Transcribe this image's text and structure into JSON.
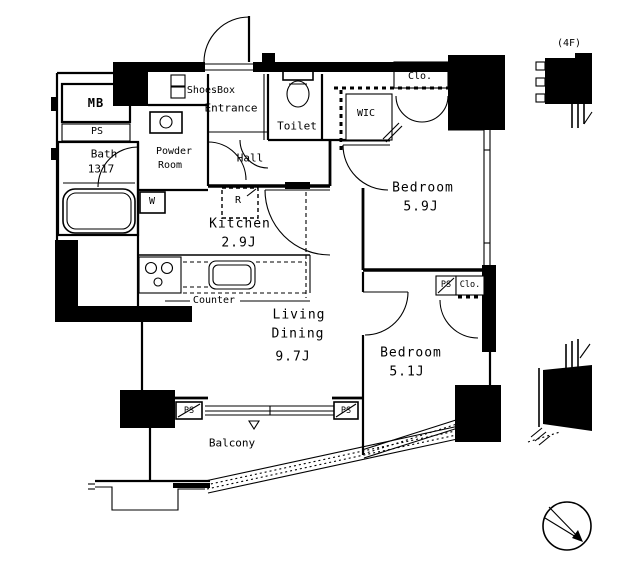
{
  "meta": {
    "floor_tag": "(4F)"
  },
  "rooms": {
    "entrance": {
      "label": "Entrance"
    },
    "shoes_box": {
      "label": "ShoesBox"
    },
    "hall": {
      "label": "Hall"
    },
    "toilet": {
      "label": "Toilet"
    },
    "wic": {
      "label": "WIC"
    },
    "powder_room": {
      "line1": "Powder",
      "line2": "Room"
    },
    "bath": {
      "label": "Bath",
      "size": "1317"
    },
    "kitchen": {
      "label": "Kitchen",
      "size": "2.9J"
    },
    "living_dining": {
      "line1": "Living",
      "line2": "Dining",
      "size": "9.7J"
    },
    "bedroom_1": {
      "label": "Bedroom",
      "size": "5.9J"
    },
    "bedroom_2": {
      "label": "Bedroom",
      "size": "5.1J"
    },
    "balcony": {
      "label": "Balcony"
    }
  },
  "fixtures": {
    "meter_box": "MB",
    "pipe_space": "PS",
    "closet": "Clo.",
    "counter": "Counter",
    "refrigerator": "R",
    "washing_machine": "W"
  },
  "colors": {
    "line": "#000000",
    "background": "#ffffff"
  }
}
